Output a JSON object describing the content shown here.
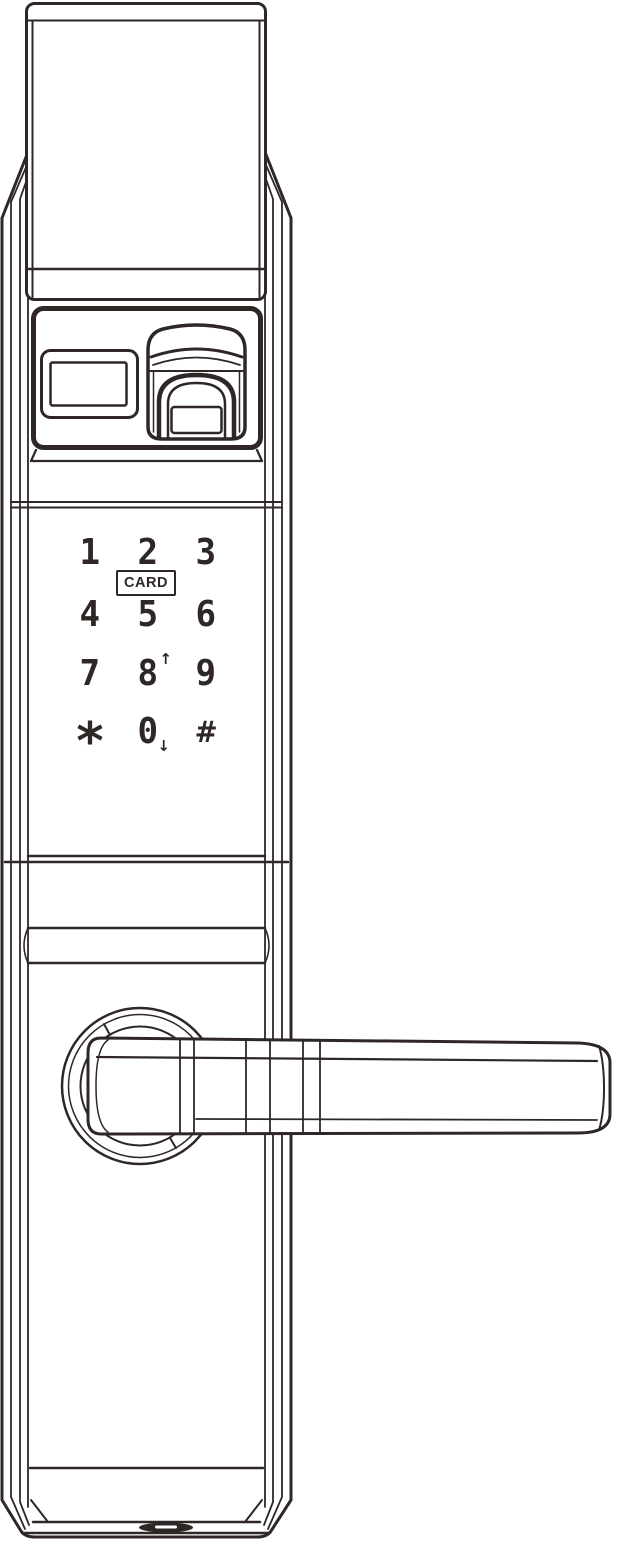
{
  "drawing": {
    "line_color": "#2e2726",
    "background_color": "#ffffff"
  },
  "keypad": {
    "card_label": "CARD",
    "keys": [
      {
        "label": "1",
        "arrow": ""
      },
      {
        "label": "2",
        "arrow": ""
      },
      {
        "label": "3",
        "arrow": ""
      },
      {
        "label": "4",
        "arrow": ""
      },
      {
        "label": "5",
        "arrow": ""
      },
      {
        "label": "6",
        "arrow": ""
      },
      {
        "label": "7",
        "arrow": ""
      },
      {
        "label": "8",
        "arrow": "↑"
      },
      {
        "label": "9",
        "arrow": ""
      },
      {
        "label": "*",
        "arrow": ""
      },
      {
        "label": "0",
        "arrow": "↓"
      },
      {
        "label": "#",
        "arrow": ""
      }
    ]
  }
}
